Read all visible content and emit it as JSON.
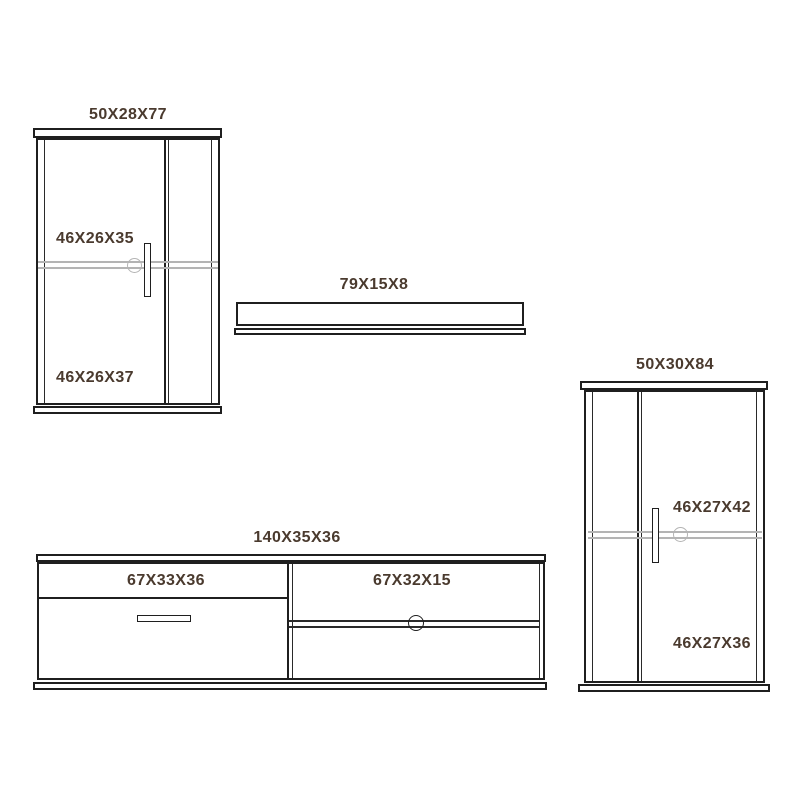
{
  "diagram": {
    "background": "#ffffff",
    "line_color": "#1f1f1f",
    "shelf_line_color": "#b4b4b4",
    "label_color": "#4a3a2e",
    "pieces": {
      "left_cabinet": {
        "size_label": "50X28X77",
        "upper_compartment_label": "46X26X35",
        "lower_compartment_label": "46X26X37"
      },
      "wall_shelf": {
        "size_label": "79X15X8"
      },
      "right_cabinet": {
        "size_label": "50X30X84",
        "upper_compartment_label": "46X27X42",
        "lower_compartment_label": "46X27X36"
      },
      "tv_unit": {
        "size_label": "140X35X36",
        "left_compartment_label": "67X33X36",
        "right_compartment_label": "67X32X15"
      }
    }
  }
}
